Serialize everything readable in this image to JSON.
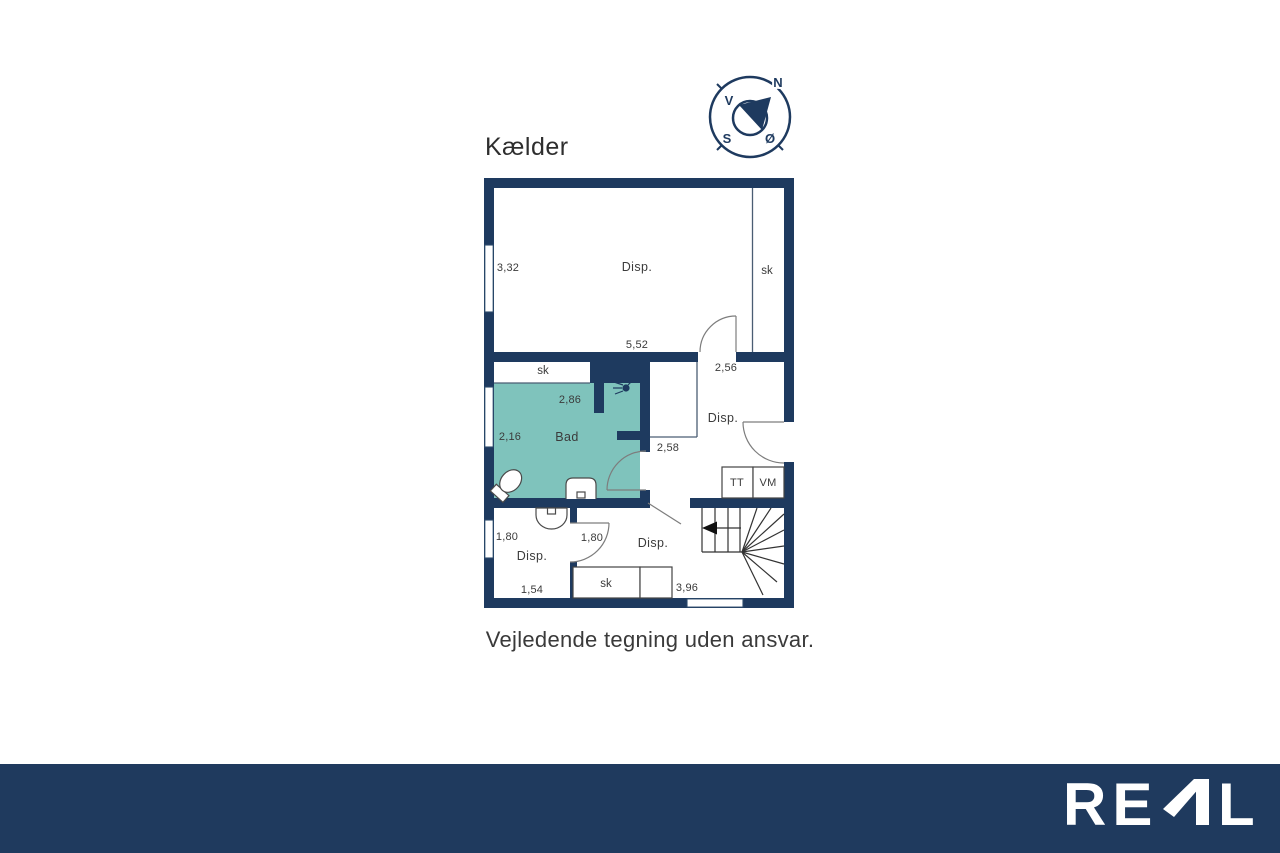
{
  "title": "Kælder",
  "caption": "Vejledende tegning uden ansvar.",
  "colors": {
    "wall_navy": "#1e3a5f",
    "bad_room_fill": "#7fc3bc",
    "footer_bg": "#1f3a5e",
    "label_text": "#3b3b3b"
  },
  "compass": {
    "n": "N",
    "v": "V",
    "s": "S",
    "o": "Ø"
  },
  "footer": {
    "brand": "REAL",
    "brand_part_re": "RE",
    "brand_part_l": "L"
  },
  "plan": {
    "floor_name": "Kælder",
    "labels": [
      {
        "kind": "dimension",
        "text": "3,32"
      },
      {
        "kind": "room",
        "text": "Disp."
      },
      {
        "kind": "closet",
        "text": "sk"
      },
      {
        "kind": "dimension",
        "text": "5,52"
      },
      {
        "kind": "dimension",
        "text": "2,56"
      },
      {
        "kind": "closet",
        "text": "sk"
      },
      {
        "kind": "dimension",
        "text": "2,86"
      },
      {
        "kind": "dimension",
        "text": "2,16"
      },
      {
        "kind": "room",
        "text": "Bad"
      },
      {
        "kind": "dimension",
        "text": "2,58"
      },
      {
        "kind": "room",
        "text": "Disp."
      },
      {
        "kind": "appliance",
        "text": "TT"
      },
      {
        "kind": "appliance",
        "text": "VM"
      },
      {
        "kind": "dimension",
        "text": "1,80"
      },
      {
        "kind": "dimension",
        "text": "1,80"
      },
      {
        "kind": "room",
        "text": "Disp."
      },
      {
        "kind": "dimension",
        "text": "1,54"
      },
      {
        "kind": "room",
        "text": "Disp."
      },
      {
        "kind": "closet",
        "text": "sk"
      },
      {
        "kind": "dimension",
        "text": "3,96"
      }
    ]
  }
}
